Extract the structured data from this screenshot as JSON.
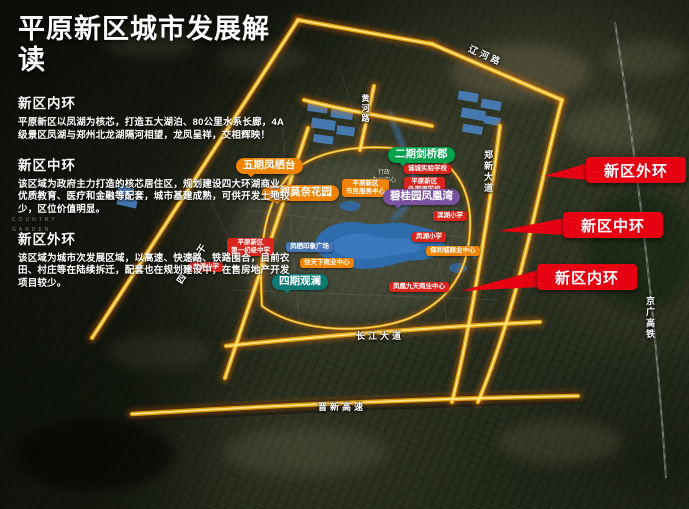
{
  "title": "平原新区城市发展解读",
  "sections": [
    {
      "heading": "新区内环",
      "body": "平原新区以凤湖为核芯，打造五大湖泊、80公里水系长廊，4A级景区凤湖与郑州北龙湖隔河相望，龙凤呈祥，交相辉映！"
    },
    {
      "heading": "新区中环",
      "body": "该区域为政府主力打造的核芯居住区，规划建设四大环湖商业、优质教育、医疗和金融等配套，城市基建成熟，可供开发土地较少，区位价值明显。"
    },
    {
      "heading": "新区外环",
      "body": "该区域为城市次发展区域，以高速、快速路、铁路围合，目前农田、村庄等在陆续拆迁，配套也在规划建设中，在售房地产开发项目较少。"
    }
  ],
  "ring_callouts": [
    {
      "label": "新区外环"
    },
    {
      "label": "新区中环"
    },
    {
      "label": "新区内环"
    }
  ],
  "projects": [
    {
      "name": "五期凤栖台"
    },
    {
      "name": "三期莫奈花园"
    },
    {
      "name": "二期剑桥郡"
    },
    {
      "name": "碧桂园凤凰湾"
    },
    {
      "name": "四期观澜"
    }
  ],
  "pois": [
    {
      "name": "诚城实验学校"
    },
    {
      "line1": "平原新区",
      "line2": "外国语学校"
    },
    {
      "name": "滨湖小学"
    },
    {
      "name": "凤湖小学"
    },
    {
      "line1": "平原新区",
      "line2": "第一初级中学"
    },
    {
      "name": "龙源小学"
    },
    {
      "name": "凤栖印象广场"
    },
    {
      "name": "住天下商业中心"
    },
    {
      "name": "保利城商业中心"
    },
    {
      "name": "凤凰九天商业中心"
    },
    {
      "line1": "平原新区",
      "line2": "市民服务中心"
    }
  ],
  "roads": [
    {
      "name": "辽河路"
    },
    {
      "name": "黄河路"
    },
    {
      "name": "郑新大道"
    },
    {
      "name": "京广高铁"
    },
    {
      "name": "长江大道"
    },
    {
      "name": "晋新高速"
    },
    {
      "name": "四大主干"
    }
  ],
  "map_texts": [
    {
      "text": "行政"
    },
    {
      "text": "办公中心"
    },
    {
      "text": "COUNTRY"
    },
    {
      "text": "GARDEN"
    }
  ],
  "colors": {
    "road_glow": "#ff7a00",
    "road_mid": "#ffb400",
    "road_core": "#ffe98f",
    "callout_red": "#e60012",
    "label_red": "#d9251d",
    "label_orange": "#f08300",
    "label_green": "#00a14b",
    "label_purple": "#7a52a0",
    "label_teal": "#0e7a74",
    "label_blue": "#4a74b8",
    "lake_blue": "#2f6cad",
    "rail_gray": "#d9dee2"
  }
}
